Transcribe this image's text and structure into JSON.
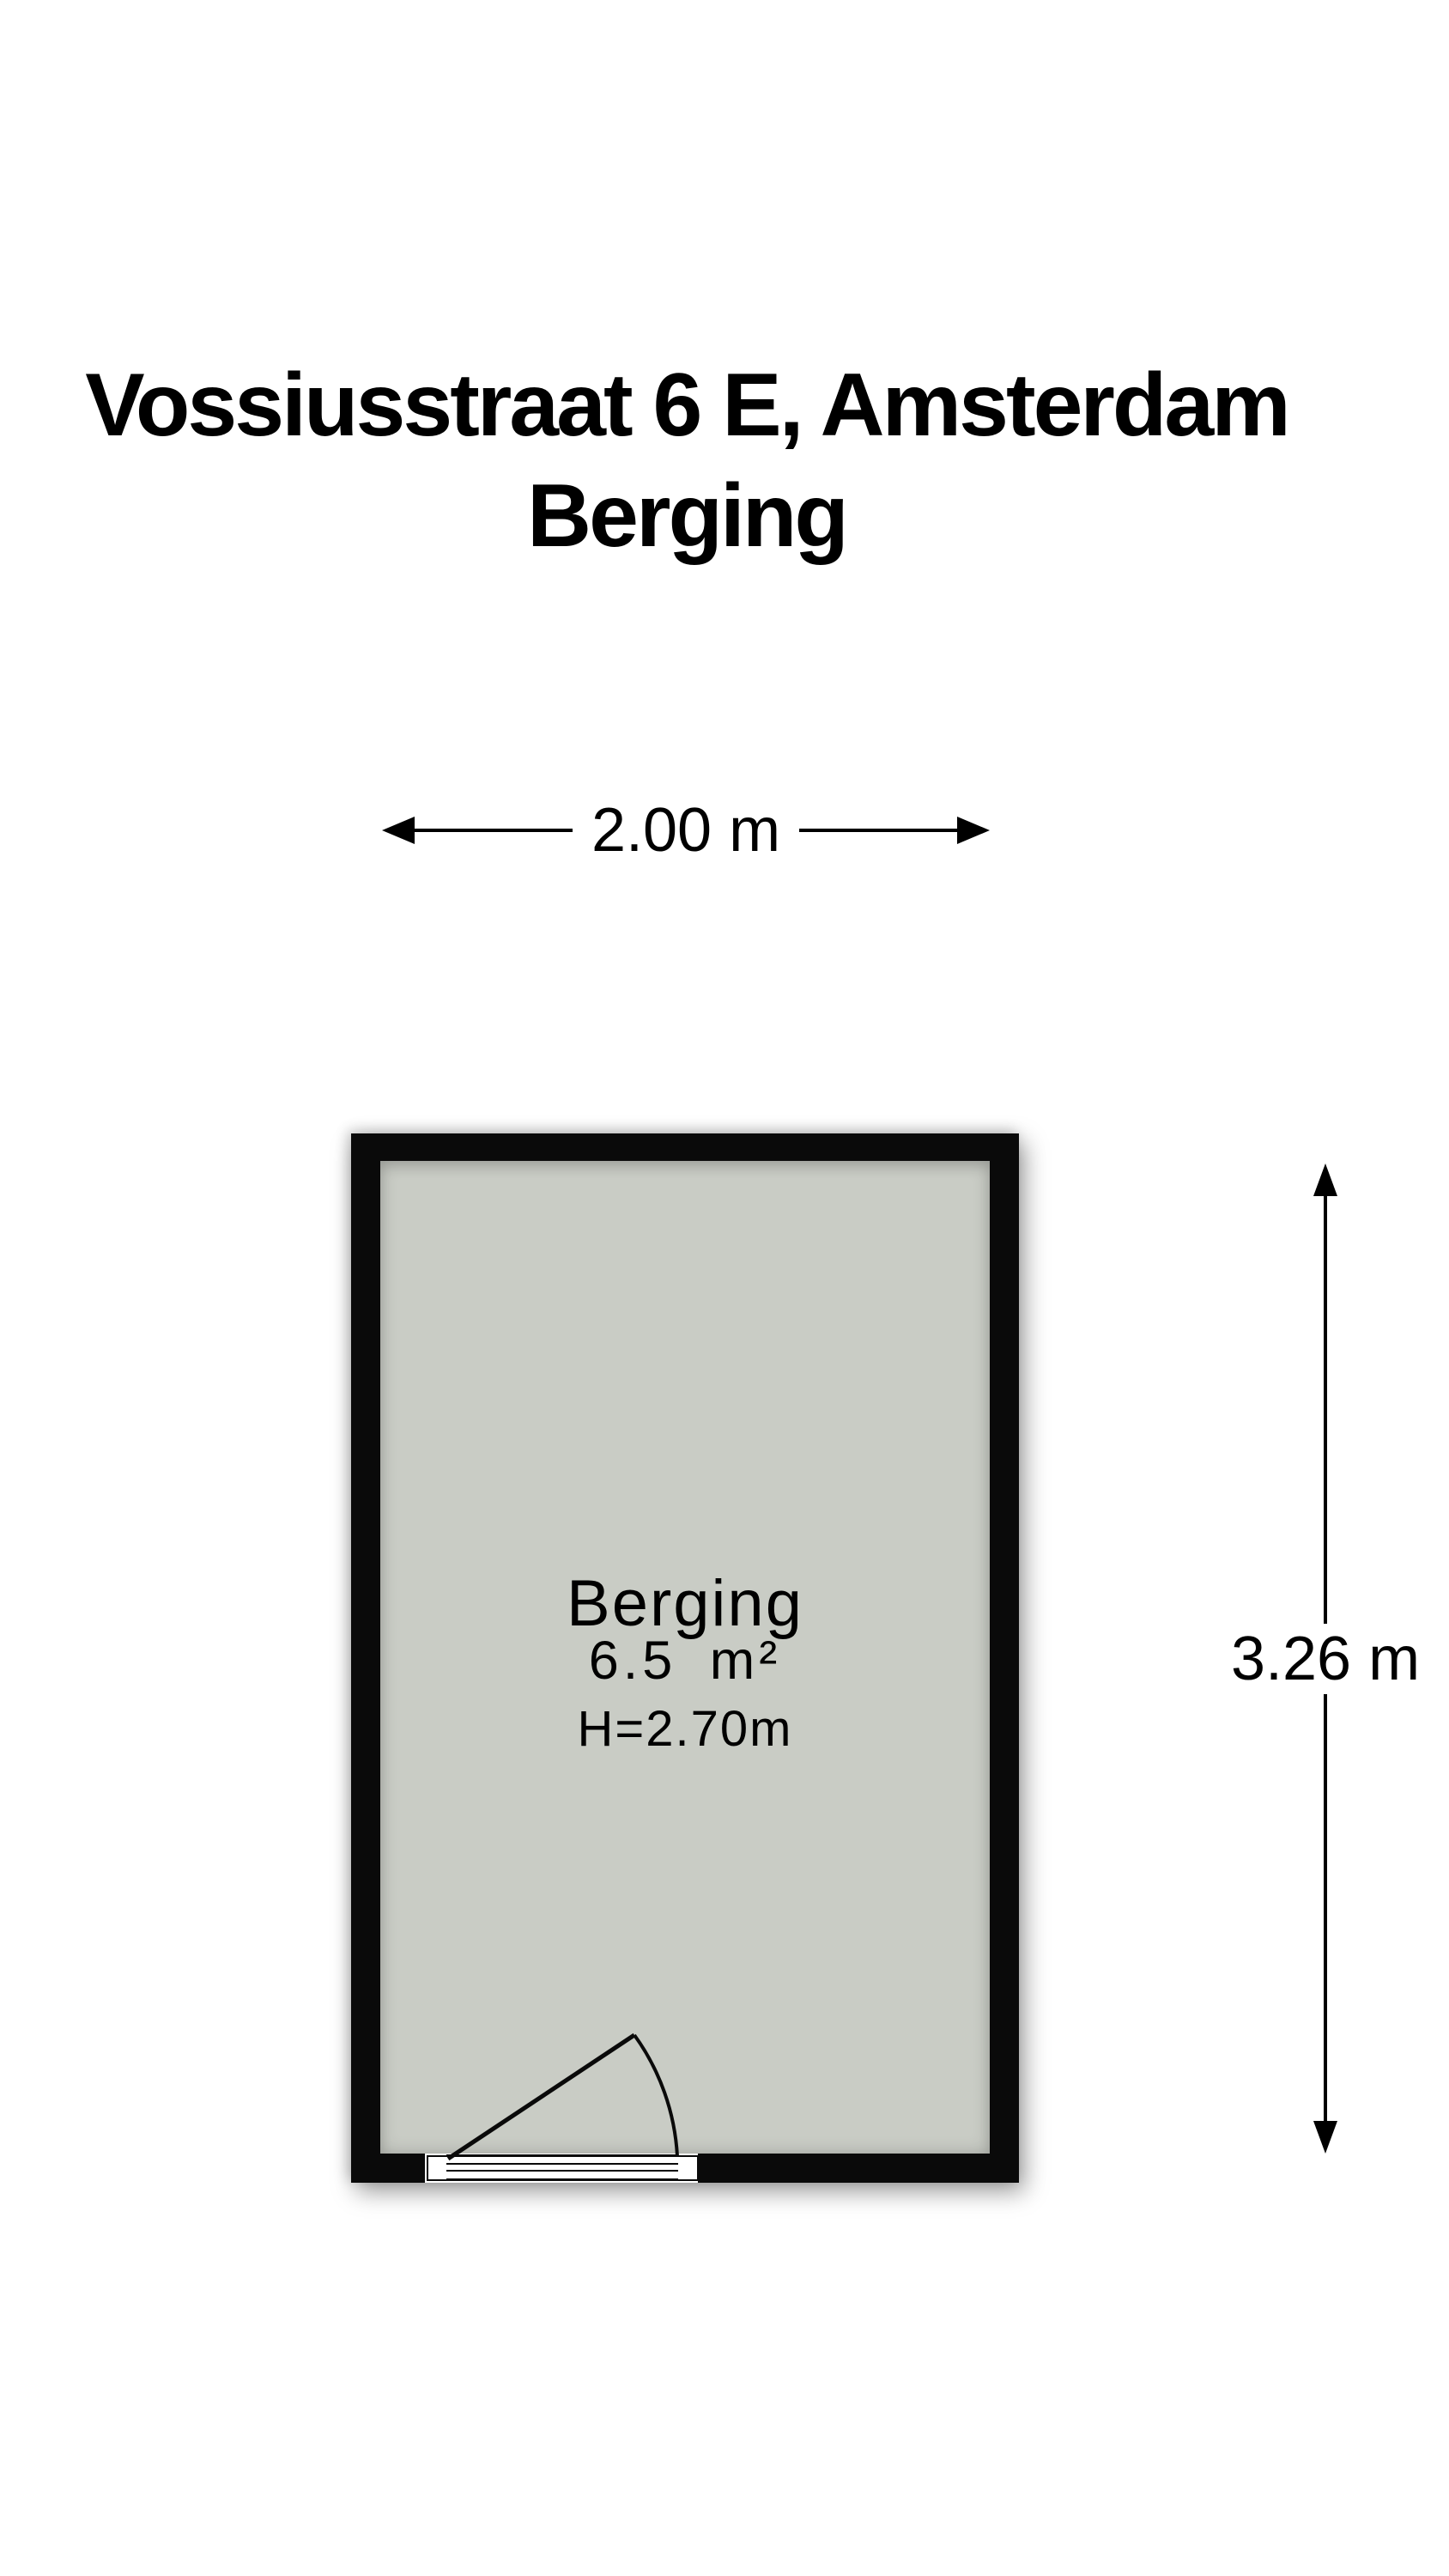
{
  "title": {
    "line1": "Vossiusstraat 6 E, Amsterdam",
    "line2": "Berging"
  },
  "dimensions": {
    "width_label": "2.00 m",
    "height_label": "3.26 m"
  },
  "room": {
    "name": "Berging",
    "area": "6.5 m²",
    "ceiling_height": "H=2.70m"
  },
  "colors": {
    "wall": "#0a0a0a",
    "floor": "#c9ccc5",
    "text": "#000000",
    "background": "#ffffff"
  }
}
